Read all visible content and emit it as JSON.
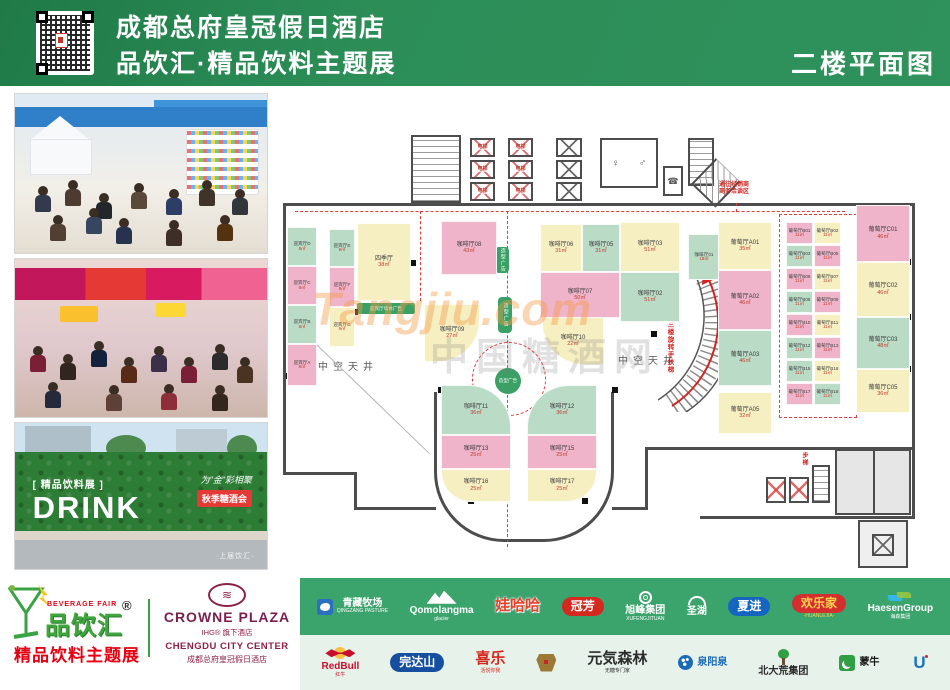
{
  "header": {
    "hotel": "成都总府皇冠假日酒店",
    "expo": "品饮汇·精品饮料主题展",
    "floor": "二楼平面图"
  },
  "photos": {
    "p3": {
      "tag": "[ 精品饮料展 ]",
      "drink": "DRINK",
      "slogan": "为\"金\"彩相聚",
      "banner": "秋季糖酒会",
      "footnote": "·上届饮汇·"
    }
  },
  "plan": {
    "labels": {
      "elevator": "电梯",
      "atrium": "中空天井",
      "biz1": "通往经销商",
      "biz2": "商务洽谈区",
      "escalator": "通往三楼旋转手扶梯",
      "stair": "步梯",
      "shape_ad": "造型广告",
      "wall_ad": "迎宾厅墙体广告",
      "watermark1": "Tangjiu.com",
      "watermark2": "中国糖酒网"
    },
    "rooms": [
      {
        "id": "yb-d",
        "name": "迎宾厅D",
        "area": "8㎡",
        "color": "green",
        "x": 287,
        "y": 227,
        "w": 30,
        "h": 39,
        "small": true
      },
      {
        "id": "yb-c",
        "name": "迎宾厅C",
        "area": "8㎡",
        "color": "pink",
        "x": 287,
        "y": 266,
        "w": 30,
        "h": 39,
        "small": true
      },
      {
        "id": "yb-b",
        "name": "迎宾厅B",
        "area": "8㎡",
        "color": "green",
        "x": 287,
        "y": 305,
        "w": 30,
        "h": 39,
        "small": true
      },
      {
        "id": "yb-a",
        "name": "迎宾厅A",
        "area": "8㎡",
        "color": "pink",
        "x": 287,
        "y": 344,
        "w": 30,
        "h": 42,
        "small": true
      },
      {
        "id": "yb-e",
        "name": "迎宾厅E",
        "area": "9㎡",
        "color": "green",
        "x": 329,
        "y": 229,
        "w": 26,
        "h": 38,
        "small": true
      },
      {
        "id": "yb-f",
        "name": "迎宾厅F",
        "area": "9㎡",
        "color": "pink",
        "x": 329,
        "y": 267,
        "w": 26,
        "h": 40,
        "small": true
      },
      {
        "id": "yb-g",
        "name": "迎宾厅G",
        "area": "9㎡",
        "color": "yellow",
        "x": 329,
        "y": 307,
        "w": 26,
        "h": 40,
        "small": true
      },
      {
        "id": "siji",
        "name": "四季厅",
        "area": "38㎡",
        "color": "yellow",
        "x": 357,
        "y": 223,
        "w": 54,
        "h": 78
      },
      {
        "id": "kf08",
        "name": "咖啡厅08",
        "area": "43㎡",
        "color": "pink",
        "x": 441,
        "y": 221,
        "w": 56,
        "h": 54
      },
      {
        "id": "kf09",
        "name": "咖啡厅09",
        "area": "27㎡",
        "color": "yellow",
        "x": 424,
        "y": 304,
        "w": 56,
        "h": 58,
        "radius": "0 0 42px 0"
      },
      {
        "id": "kf10",
        "name": "咖啡厅10",
        "area": "22㎡",
        "color": "yellow",
        "x": 542,
        "y": 317,
        "w": 62,
        "h": 48,
        "radius": "0 0 0 42px"
      },
      {
        "id": "kf06",
        "name": "咖啡厅06",
        "area": "31㎡",
        "color": "yellow",
        "x": 540,
        "y": 224,
        "w": 42,
        "h": 48
      },
      {
        "id": "kf05",
        "name": "咖啡厅05",
        "area": "31㎡",
        "color": "green",
        "x": 582,
        "y": 224,
        "w": 38,
        "h": 48
      },
      {
        "id": "kf03",
        "name": "咖啡厅03",
        "area": "51㎡",
        "color": "yellow",
        "x": 620,
        "y": 222,
        "w": 60,
        "h": 50
      },
      {
        "id": "kf07",
        "name": "咖啡厅07",
        "area": "50㎡",
        "color": "pink",
        "x": 540,
        "y": 272,
        "w": 80,
        "h": 46
      },
      {
        "id": "kf02",
        "name": "咖啡厅02",
        "area": "51㎡",
        "color": "green",
        "x": 620,
        "y": 272,
        "w": 60,
        "h": 50
      },
      {
        "id": "kf11",
        "name": "咖啡厅11",
        "area": "36㎡",
        "color": "green",
        "x": 441,
        "y": 385,
        "w": 70,
        "h": 50,
        "radius": "0 42px 0 0"
      },
      {
        "id": "kf12",
        "name": "咖啡厅12",
        "area": "36㎡",
        "color": "green",
        "x": 527,
        "y": 385,
        "w": 70,
        "h": 50,
        "radius": "42px 0 0 0"
      },
      {
        "id": "kf13",
        "name": "咖啡厅13",
        "area": "25㎡",
        "color": "pink",
        "x": 441,
        "y": 435,
        "w": 70,
        "h": 34
      },
      {
        "id": "kf15",
        "name": "咖啡厅15",
        "area": "25㎡",
        "color": "pink",
        "x": 527,
        "y": 435,
        "w": 70,
        "h": 34
      },
      {
        "id": "kf16",
        "name": "咖啡厅16",
        "area": "25㎡",
        "color": "yellow",
        "x": 441,
        "y": 469,
        "w": 70,
        "h": 33,
        "radius": "0 0 0 30px"
      },
      {
        "id": "kf17",
        "name": "咖啡厅17",
        "area": "25㎡",
        "color": "yellow",
        "x": 527,
        "y": 469,
        "w": 70,
        "h": 33,
        "radius": "0 0 30px 0"
      },
      {
        "id": "kf01",
        "name": "咖啡厅01",
        "area": "18㎡",
        "color": "green",
        "x": 688,
        "y": 234,
        "w": 32,
        "h": 46,
        "small": true
      },
      {
        "id": "pt-a01",
        "name": "葡萄厅A01",
        "area": "35㎡",
        "color": "yellow",
        "x": 718,
        "y": 222,
        "w": 54,
        "h": 48
      },
      {
        "id": "pt-a02",
        "name": "葡萄厅A02",
        "area": "46㎡",
        "color": "pink",
        "x": 718,
        "y": 270,
        "w": 54,
        "h": 60
      },
      {
        "id": "pt-a03",
        "name": "葡萄厅A03",
        "area": "46㎡",
        "color": "green",
        "x": 718,
        "y": 330,
        "w": 54,
        "h": 56
      },
      {
        "id": "pt-a05",
        "name": "葡萄厅A05",
        "area": "32㎡",
        "color": "yellow",
        "x": 718,
        "y": 392,
        "w": 54,
        "h": 42
      },
      {
        "id": "pt-b01",
        "name": "葡萄厅B01",
        "area": "11㎡",
        "color": "pink",
        "x": 786,
        "y": 222,
        "w": 27,
        "h": 22,
        "small": true
      },
      {
        "id": "pt-b02",
        "name": "葡萄厅B02",
        "area": "11㎡",
        "color": "yellow",
        "x": 814,
        "y": 222,
        "w": 27,
        "h": 22,
        "small": true
      },
      {
        "id": "pt-b03",
        "name": "葡萄厅B03",
        "area": "11㎡",
        "color": "green",
        "x": 786,
        "y": 245,
        "w": 27,
        "h": 22,
        "small": true
      },
      {
        "id": "pt-b05",
        "name": "葡萄厅B05",
        "area": "11㎡",
        "color": "pink",
        "x": 814,
        "y": 245,
        "w": 27,
        "h": 22,
        "small": true
      },
      {
        "id": "pt-b06",
        "name": "葡萄厅B06",
        "area": "11㎡",
        "color": "pink",
        "x": 786,
        "y": 268,
        "w": 27,
        "h": 22,
        "small": true
      },
      {
        "id": "pt-b07",
        "name": "葡萄厅B07",
        "area": "11㎡",
        "color": "yellow",
        "x": 814,
        "y": 268,
        "w": 27,
        "h": 22,
        "small": true
      },
      {
        "id": "pt-b08",
        "name": "葡萄厅B08",
        "area": "11㎡",
        "color": "green",
        "x": 786,
        "y": 291,
        "w": 27,
        "h": 22,
        "small": true
      },
      {
        "id": "pt-b09",
        "name": "葡萄厅B09",
        "area": "11㎡",
        "color": "pink",
        "x": 814,
        "y": 291,
        "w": 27,
        "h": 22,
        "small": true
      },
      {
        "id": "pt-b10",
        "name": "葡萄厅B10",
        "area": "11㎡",
        "color": "pink",
        "x": 786,
        "y": 314,
        "w": 27,
        "h": 22,
        "small": true
      },
      {
        "id": "pt-b11",
        "name": "葡萄厅B11",
        "area": "11㎡",
        "color": "yellow",
        "x": 814,
        "y": 314,
        "w": 27,
        "h": 22,
        "small": true
      },
      {
        "id": "pt-b12",
        "name": "葡萄厅B12",
        "area": "11㎡",
        "color": "green",
        "x": 786,
        "y": 337,
        "w": 27,
        "h": 22,
        "small": true
      },
      {
        "id": "pt-b13",
        "name": "葡萄厅B13",
        "area": "11㎡",
        "color": "pink",
        "x": 814,
        "y": 337,
        "w": 27,
        "h": 22,
        "small": true
      },
      {
        "id": "pt-b15",
        "name": "葡萄厅B15",
        "area": "11㎡",
        "color": "green",
        "x": 786,
        "y": 360,
        "w": 27,
        "h": 22,
        "small": true
      },
      {
        "id": "pt-b16",
        "name": "葡萄厅B16",
        "area": "11㎡",
        "color": "yellow",
        "x": 814,
        "y": 360,
        "w": 27,
        "h": 22,
        "small": true
      },
      {
        "id": "pt-b17",
        "name": "葡萄厅B17",
        "area": "11㎡",
        "color": "pink",
        "x": 786,
        "y": 383,
        "w": 27,
        "h": 22,
        "small": true
      },
      {
        "id": "pt-b18",
        "name": "葡萄厅B18",
        "area": "11㎡",
        "color": "green",
        "x": 814,
        "y": 383,
        "w": 27,
        "h": 22,
        "small": true
      },
      {
        "id": "pt-c01",
        "name": "葡萄厅C01",
        "area": "46㎡",
        "color": "pink",
        "x": 856,
        "y": 205,
        "w": 54,
        "h": 57
      },
      {
        "id": "pt-c02",
        "name": "葡萄厅C02",
        "area": "46㎡",
        "color": "yellow",
        "x": 856,
        "y": 262,
        "w": 54,
        "h": 55
      },
      {
        "id": "pt-c03",
        "name": "葡萄厅C03",
        "area": "48㎡",
        "color": "green",
        "x": 856,
        "y": 317,
        "w": 54,
        "h": 52
      },
      {
        "id": "pt-c05",
        "name": "葡萄厅C05",
        "area": "36㎡",
        "color": "yellow",
        "x": 856,
        "y": 369,
        "w": 54,
        "h": 44
      }
    ]
  },
  "footer": {
    "brand": {
      "fair": "BEVERAGE FAIR",
      "name": "品饮汇",
      "reg": "®",
      "subtitle": "精品饮料主题展"
    },
    "hotel": {
      "symbol": "≋",
      "name": "CROWNE PLAZA",
      "group": "IHG® 旗下酒店",
      "center": "CHENGDU CITY CENTER",
      "cn": "成都总府皇冠假日酒店"
    },
    "sponsors_row1": [
      {
        "kind": "icon-left",
        "icon": "pasture-icon",
        "name": "青藏牧场",
        "sub": "QINGZANG PASTURE",
        "color": "#ffffff"
      },
      {
        "kind": "icon-top",
        "icon": "mountain-icon",
        "name": "Qomolangma",
        "sub": "glacier",
        "color": "#ffffff"
      },
      {
        "kind": "big-text",
        "name": "娃哈哈",
        "sub": "",
        "color": "#e8402c",
        "outline": true
      },
      {
        "kind": "badge",
        "name": "冠芳",
        "bg": "#d5281e",
        "color": "#ffffff"
      },
      {
        "kind": "icon-top",
        "icon": "knot-icon",
        "name": "旭峰集团",
        "sub": "XUFENGJITUAN",
        "color": "#ffffff"
      },
      {
        "kind": "icon-top",
        "icon": "horns-icon",
        "name": "圣湖",
        "sub": "",
        "color": "#ffffff"
      },
      {
        "kind": "badge",
        "name": "夏进",
        "bg": "#1565c0",
        "color": "#ffffff"
      },
      {
        "kind": "badge",
        "name": "欢乐家",
        "sub": "-HUANLEJIA-",
        "bg": "#d32f2f",
        "color": "#ffd54f"
      },
      {
        "kind": "icon-top",
        "icon": "leaf-icon",
        "name": "HaesenGroup",
        "sub": "海森集团",
        "color": "#ffffff"
      }
    ],
    "sponsors_row2": [
      {
        "kind": "icon-top",
        "icon": "redbull-icon",
        "name": "RedBull",
        "sub": "红牛",
        "color": "#c8102e"
      },
      {
        "kind": "badge",
        "name": "完达山",
        "bg": "#164fa0",
        "color": "#ffffff"
      },
      {
        "kind": "big-text",
        "name": "喜乐",
        "sub": "活悦你我",
        "color": "#d5281e"
      },
      {
        "kind": "icon-only",
        "icon": "gold-crest-icon",
        "name": "",
        "sub": "",
        "color": "#9c7a35"
      },
      {
        "kind": "big-text",
        "name": "元気森林",
        "sub": "无糖专门家",
        "color": "#2b2b2b"
      },
      {
        "kind": "icon-left",
        "icon": "water-circle-icon",
        "name": "泉阳泉",
        "sub": "",
        "color": "#1a6bb5"
      },
      {
        "kind": "icon-top",
        "icon": "tree-icon",
        "name": "北大荒集团",
        "sub": "",
        "color": "#2b2b2b"
      },
      {
        "kind": "icon-left",
        "icon": "moon-crescent-icon",
        "name": "蒙牛",
        "sub": "",
        "color": "#1b1b1b"
      },
      {
        "kind": "icon-only",
        "icon": "u-icon",
        "name": "",
        "sub": "",
        "color": "#1a74c4"
      }
    ]
  }
}
